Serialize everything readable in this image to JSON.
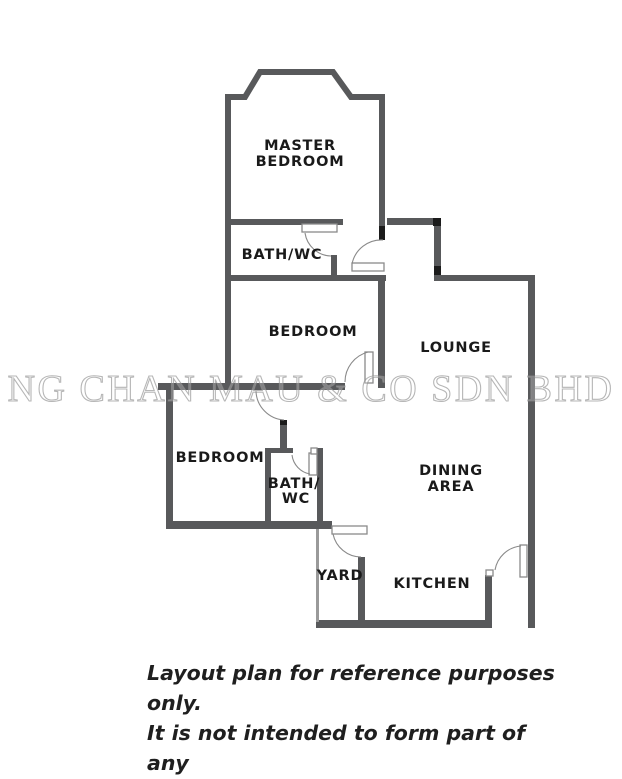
{
  "watermark": "NG CHAN MAU & CO SDN BHD",
  "rooms": [
    {
      "id": "master-bedroom",
      "lines": [
        "MASTER",
        "BEDROOM"
      ]
    },
    {
      "id": "bath-wc-upper",
      "lines": [
        "BATH/WC"
      ]
    },
    {
      "id": "bedroom-middle",
      "lines": [
        "BEDROOM"
      ]
    },
    {
      "id": "lounge",
      "lines": [
        "LOUNGE"
      ]
    },
    {
      "id": "bedroom-left",
      "lines": [
        "BEDROOM"
      ]
    },
    {
      "id": "bath-wc-lower",
      "lines": [
        "BATH/",
        "WC"
      ]
    },
    {
      "id": "dining-area",
      "lines": [
        "DINING",
        "AREA"
      ]
    },
    {
      "id": "yard",
      "lines": [
        "YARD"
      ]
    },
    {
      "id": "kitchen",
      "lines": [
        "KITCHEN"
      ]
    }
  ],
  "disclaimer": {
    "lines": [
      "Layout plan for reference purposes only.",
      "It is not intended to form part of any",
      "contract or warranty."
    ]
  },
  "colors": {
    "wall": "#58595b",
    "thin_wall": "#9a9a9a",
    "door_marker": "#1b1b1b",
    "arc": "#8a8a8a",
    "watermark": "#8f8f8f",
    "label": "#1a1a1a",
    "disclaimer": "#1f1f1f"
  }
}
